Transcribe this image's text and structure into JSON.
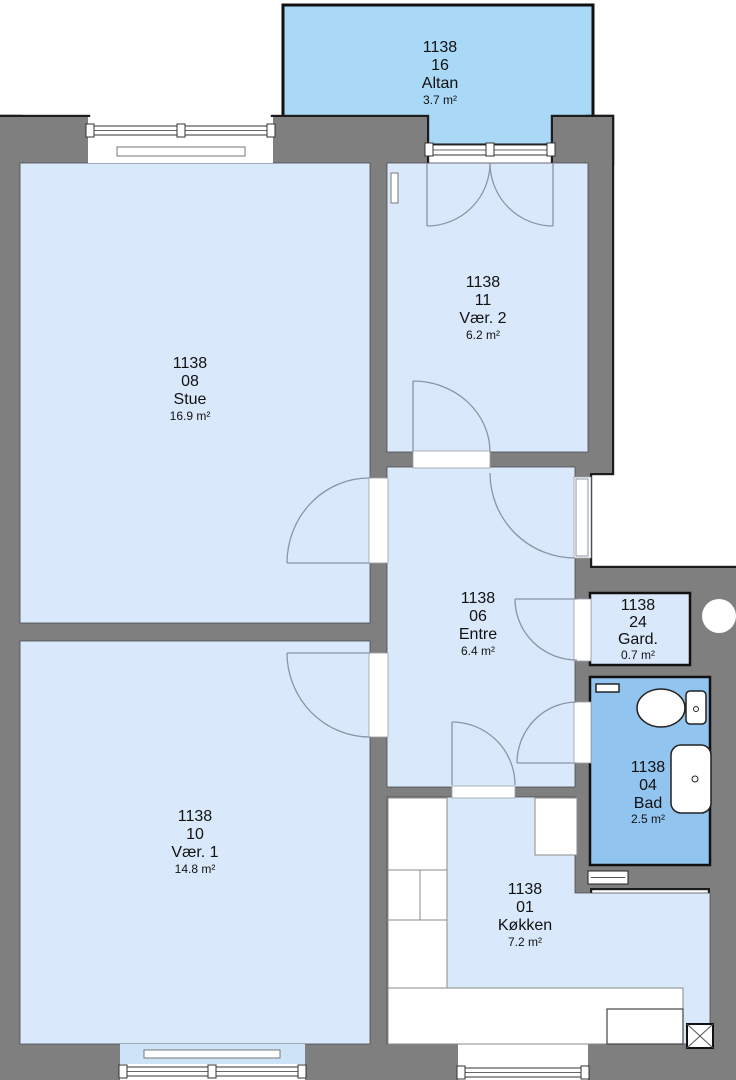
{
  "unit": "1138",
  "rooms": [
    {
      "id": "1138",
      "no": "16",
      "name": "Altan",
      "area": "3.7 m²"
    },
    {
      "id": "1138",
      "no": "08",
      "name": "Stue",
      "area": "16.9 m²"
    },
    {
      "id": "1138",
      "no": "11",
      "name": "Vær. 2",
      "area": "6.2 m²"
    },
    {
      "id": "1138",
      "no": "06",
      "name": "Entre",
      "area": "6.4 m²"
    },
    {
      "id": "1138",
      "no": "24",
      "name": "Gard.",
      "area": "0.7 m²"
    },
    {
      "id": "1138",
      "no": "04",
      "name": "Bad",
      "area": "2.5 m²"
    },
    {
      "id": "1138",
      "no": "10",
      "name": "Vær. 1",
      "area": "14.8 m²"
    },
    {
      "id": "1138",
      "no": "01",
      "name": "Køkken",
      "area": "7.2 m²"
    }
  ],
  "colors": {
    "room_fill": "#d9e9fb",
    "balcony_fill": "#aad8f7",
    "bath_fill": "#92c4f0",
    "bay_fill": "#cfe3f8",
    "wall": "#7f7f7f",
    "outline": "#1c1c1c"
  }
}
